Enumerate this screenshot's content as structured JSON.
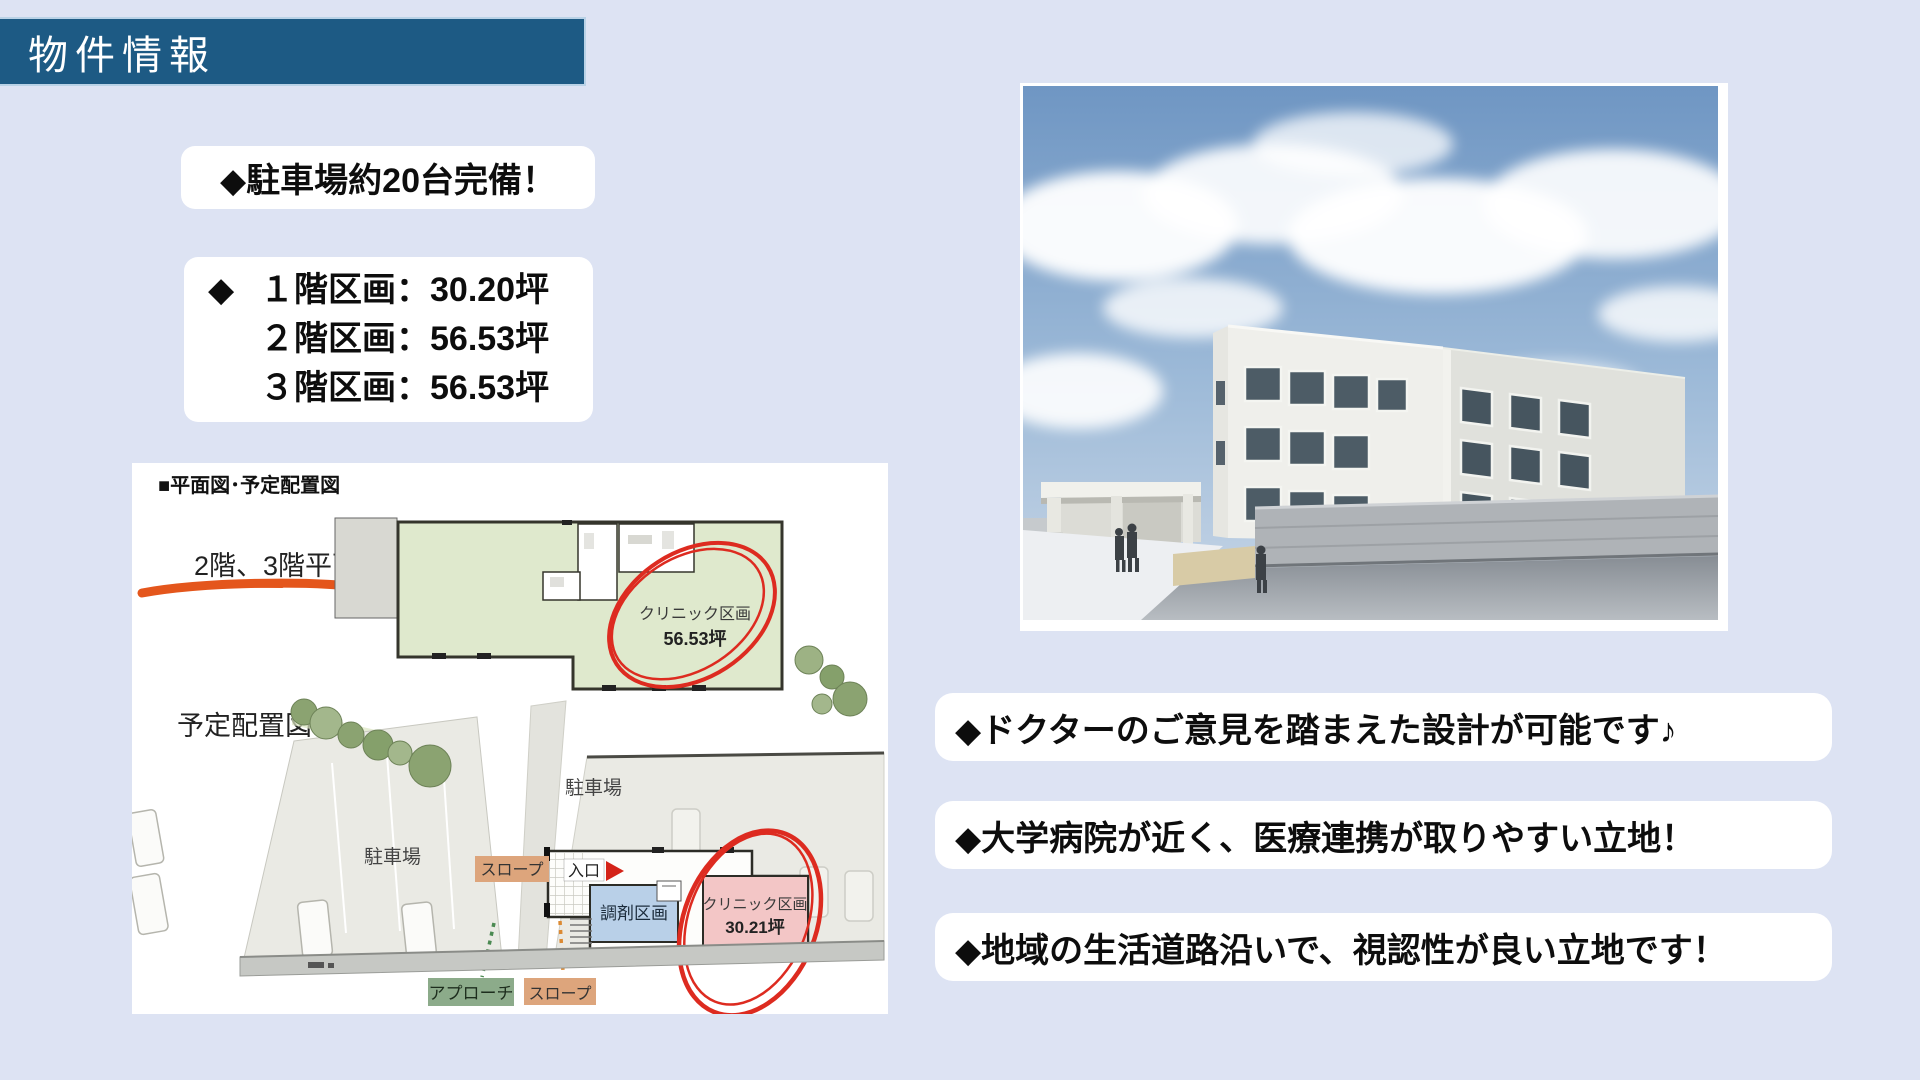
{
  "colors": {
    "background": "#dde3f3",
    "header_bg": "#1d5a84",
    "accent_red": "#dd2b20",
    "plan_green": "#dfe9cd",
    "plan_blue": "#b9d0e8",
    "plan_pink": "#f3c6c6",
    "label_tan": "#dda57c",
    "label_green": "#8cab8a",
    "underline_orange": "#e4561c"
  },
  "header": {
    "title": "物件情報"
  },
  "highlights": {
    "parking": "◆駐車場約20台完備！",
    "units": {
      "bullet": "◆",
      "lines": [
        "１階区画：30.20坪",
        "２階区画：56.53坪",
        "３階区画：56.53坪"
      ]
    }
  },
  "floorplan": {
    "title": "■平面図･予定配置図",
    "upper_plan_label": "2階、3階平面図",
    "upper_clinic_name": "クリニック区画",
    "upper_clinic_area": "56.53坪",
    "site_plan_label": "予定配置図",
    "parking_left": "駐車場",
    "parking_right": "駐車場",
    "slope_top": "スロープ",
    "entrance": "入口",
    "dispensing": "調剤区画",
    "lower_clinic_name": "クリニック区画",
    "lower_clinic_area": "30.21坪",
    "approach": "アプローチ",
    "slope_bottom": "スロープ"
  },
  "benefits": [
    "◆ドクターのご意見を踏まえた設計が可能です♪",
    "◆大学病院が近く、医療連携が取りやすい立地！",
    "◆地域の生活道路沿いで、視認性が良い立地です！"
  ]
}
